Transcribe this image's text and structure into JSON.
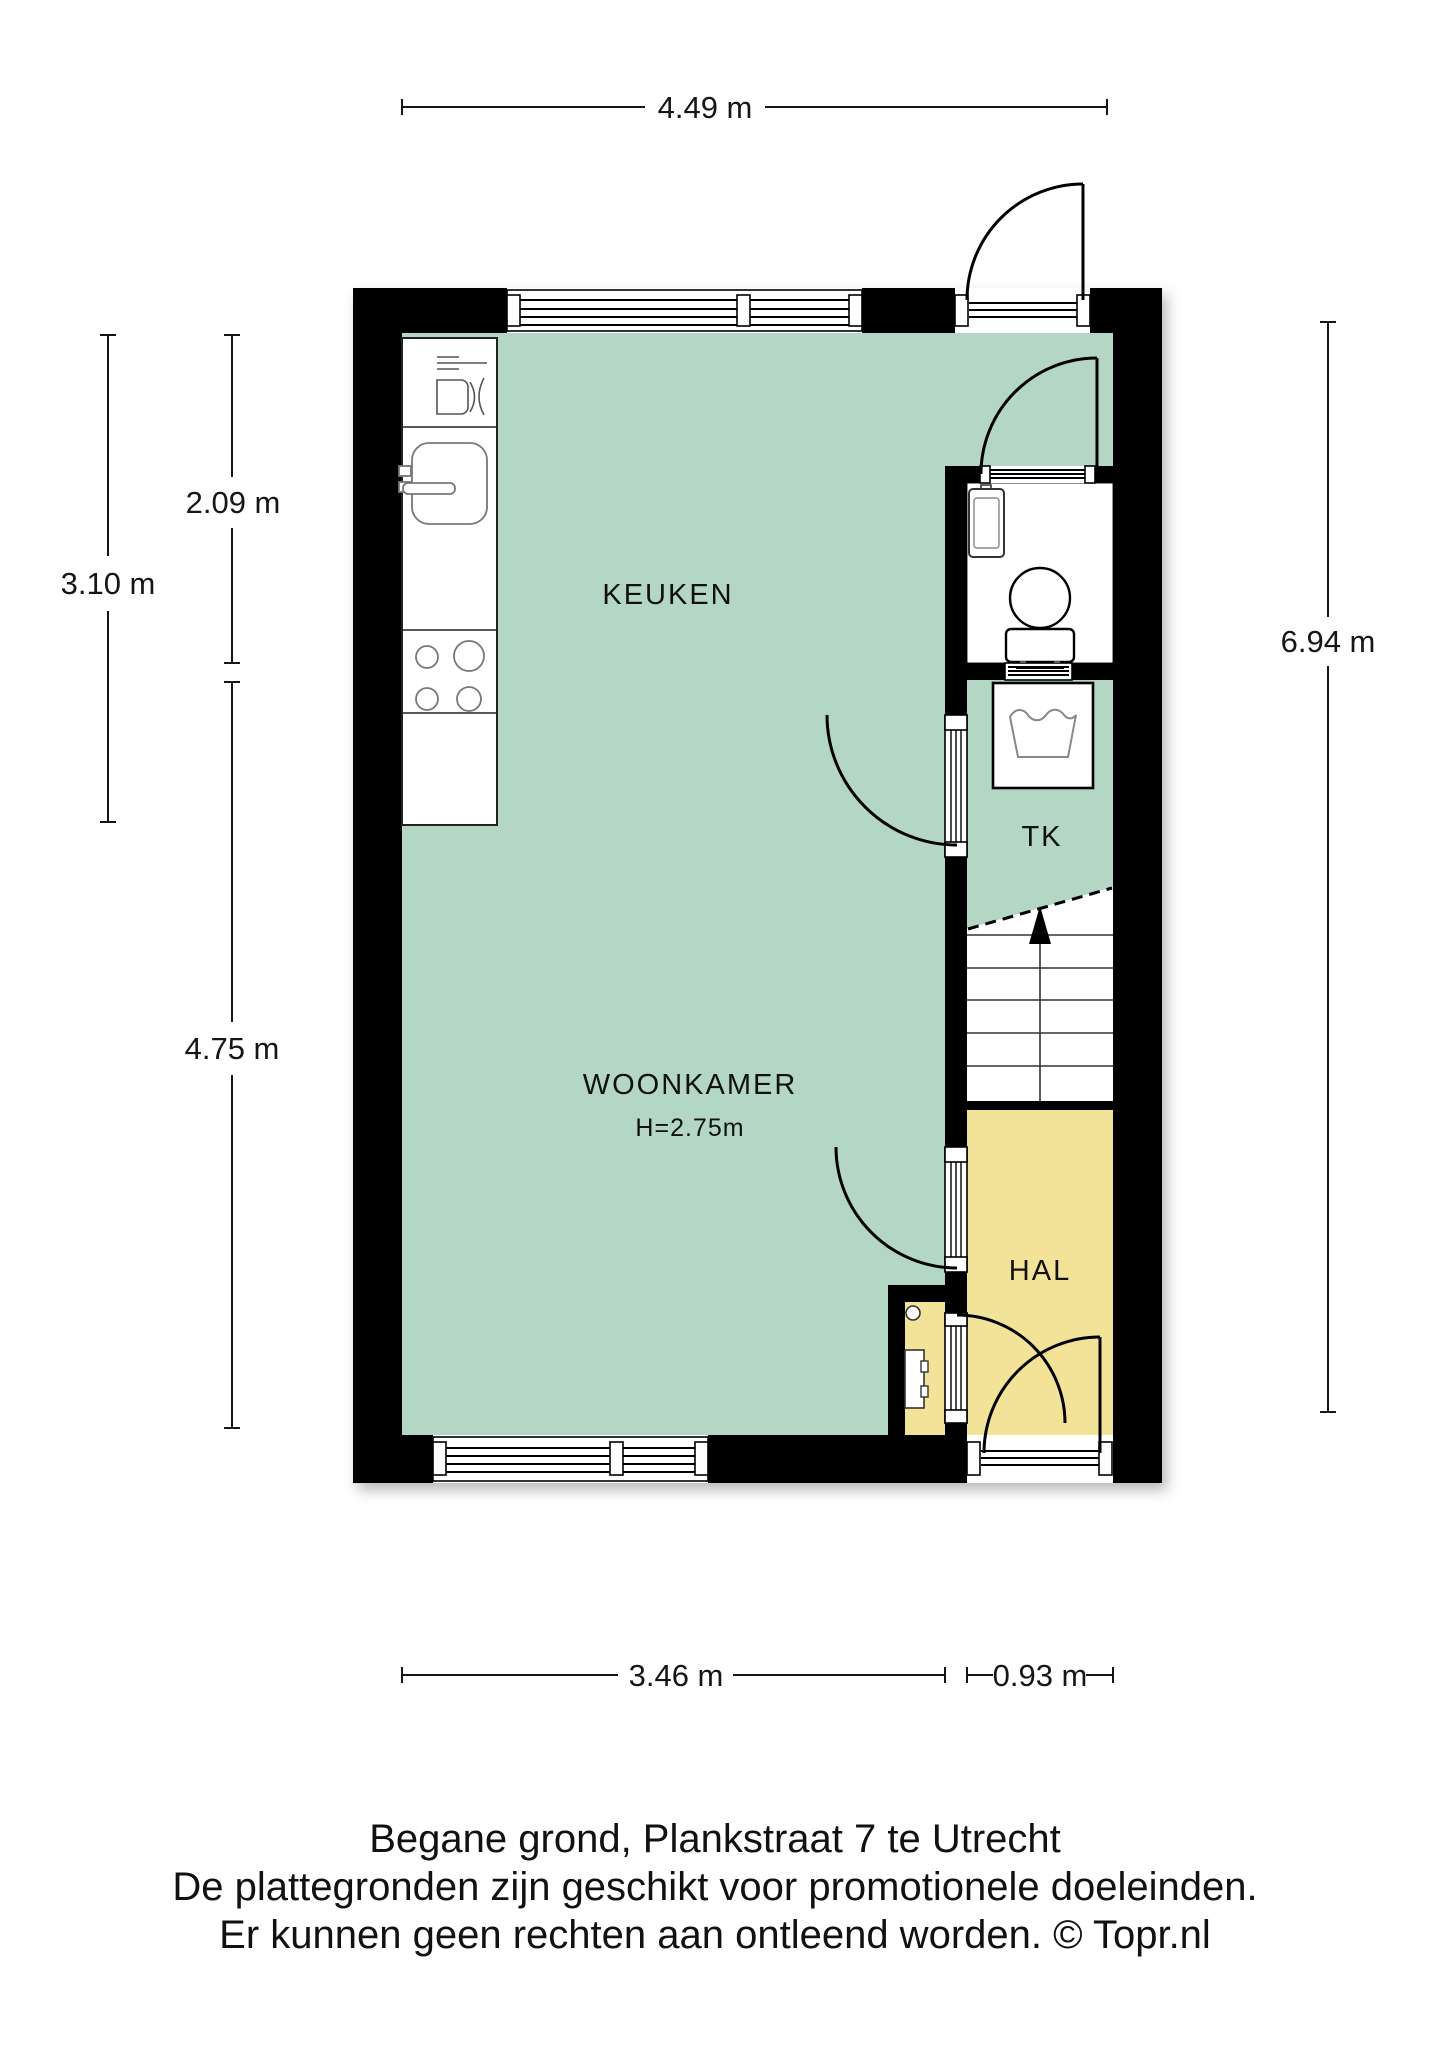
{
  "plan": {
    "rooms": {
      "keuken_label": "KEUKEN",
      "woonkamer_label": "WOONKAMER",
      "woonkamer_height": "H=2.75m",
      "tk_label": "TK",
      "hal_label": "HAL"
    },
    "dimensions": {
      "top_width": "4.49 m",
      "kitchen_depth": "2.09 m",
      "upper_left_height": "3.10 m",
      "lower_left_height": "4.75 m",
      "right_height": "6.94 m",
      "bottom_living_width": "3.46 m",
      "bottom_hall_width": "0.93 m"
    },
    "colors": {
      "living_green": "#b3d6c5",
      "hall_yellow": "#f2e399",
      "wall_black": "#000000"
    }
  },
  "caption": {
    "line1": "Begane grond, Plankstraat 7 te Utrecht",
    "line2": "De plattegronden zijn geschikt voor promotionele doeleinden.",
    "line3": "Er kunnen geen rechten aan ontleend worden. © Topr.nl"
  }
}
